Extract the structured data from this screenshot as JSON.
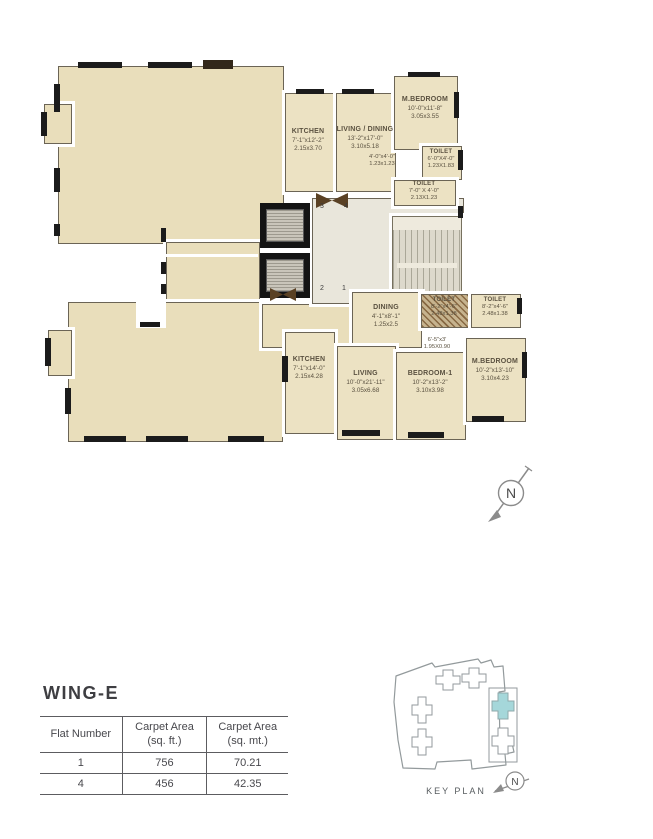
{
  "plan": {
    "north_label": "N",
    "flat_door_numbers": {
      "top_left": "3",
      "top_right": "4",
      "bottom_left": "2",
      "bottom_right": "1"
    },
    "rooms": {
      "kitchen_u": {
        "name": "KITCHEN",
        "ft": "7'-1\"x12'-2\"",
        "m": "2.15x3.70"
      },
      "living_dining_u": {
        "name": "LIVING / DINING",
        "ft": "13'-2\"x17'-0\"",
        "m": "3.10x5.18"
      },
      "mbedroom_u": {
        "name": "M.BEDROOM",
        "ft": "10'-0\"x11'-8\"",
        "m": "3.05x3.55"
      },
      "passage_u": {
        "name": "",
        "ft": "4'-0\"x4'-0\"",
        "m": "1.23x1.23"
      },
      "toilet_u1": {
        "name": "TOILET",
        "ft": "6'-0\"X4'-0\"",
        "m": "1.23X1.83"
      },
      "toilet_u2": {
        "name": "TOILET",
        "ft": "7'-0\" X 4'-0\"",
        "m": "2.13X1.23"
      },
      "dining_l": {
        "name": "DINING",
        "ft": "4'-1\"x8'-1\"",
        "m": "1.25x2.5"
      },
      "toilet_l1": {
        "name": "TOILET",
        "ft": "8'-2\"x4'-6\"",
        "m": "2.48x1.38"
      },
      "toilet_l2": {
        "name": "TOILET",
        "ft": "8'-2\"x4'-6\"",
        "m": "2.48x1.38"
      },
      "passage_l": {
        "name": "",
        "ft": "6'-5\"x3'",
        "m": "1.95X0.90"
      },
      "kitchen_l": {
        "name": "KITCHEN",
        "ft": "7'-1\"x14'-0\"",
        "m": "2.15x4.28"
      },
      "living_l": {
        "name": "LIVING",
        "ft": "10'-0\"x21'-11\"",
        "m": "3.05x6.68"
      },
      "bedroom1_l": {
        "name": "BEDROOM-1",
        "ft": "10'-2\"x13'-2\"",
        "m": "3.10x3.98"
      },
      "mbedroom_l": {
        "name": "M.BEDROOM",
        "ft": "10'-2\"x13'-10\"",
        "m": "3.10x4.23"
      }
    }
  },
  "info": {
    "wing_title": "WING-E",
    "table": {
      "headers": [
        {
          "l1": "Flat Number",
          "l2": ""
        },
        {
          "l1": "Carpet Area",
          "l2": "(sq. ft.)"
        },
        {
          "l1": "Carpet Area",
          "l2": "(sq. mt.)"
        }
      ],
      "rows": [
        [
          "1",
          "756",
          "70.21"
        ],
        [
          "4",
          "456",
          "42.35"
        ]
      ]
    }
  },
  "key_plan": {
    "label": "KEY PLAN",
    "north_label": "N",
    "highlight_color": "#a5d7da"
  }
}
